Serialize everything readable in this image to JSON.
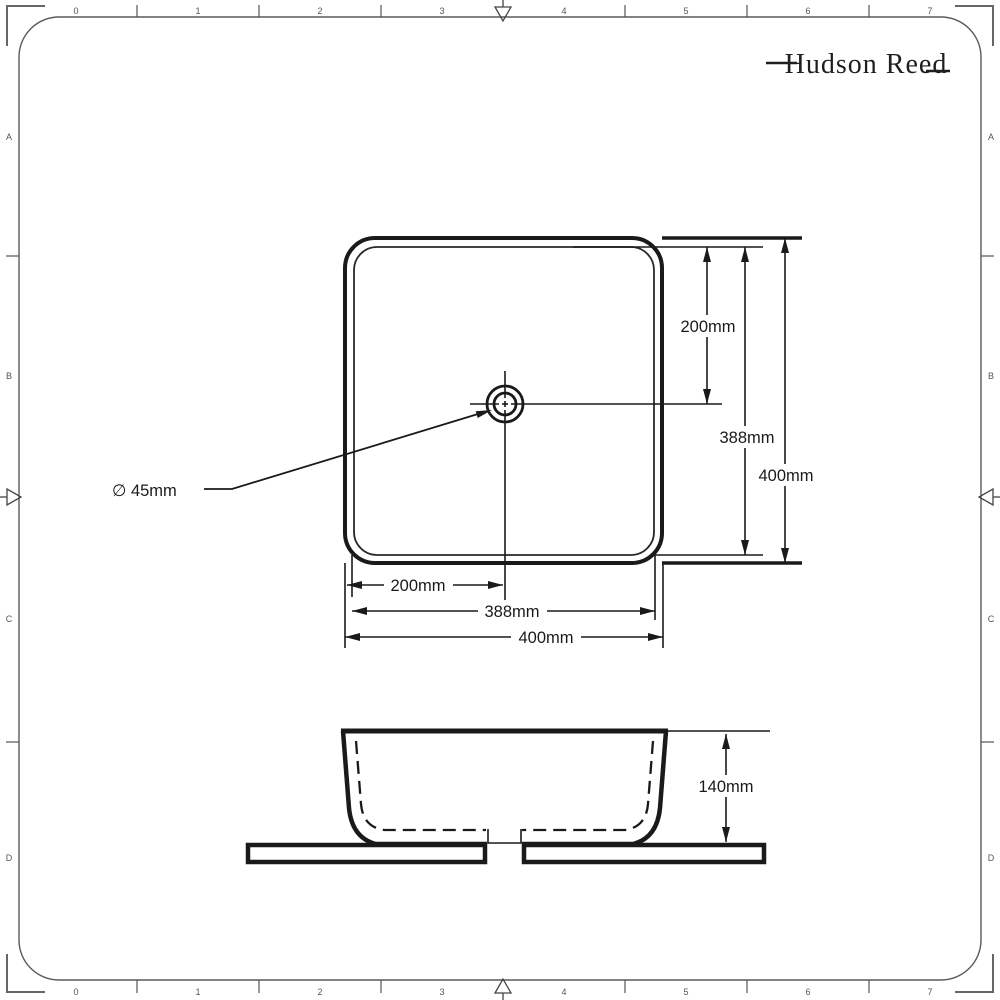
{
  "logo": {
    "text": "Hudson Reed"
  },
  "rulers": {
    "top": [
      "0",
      "1",
      "2",
      "3",
      "4",
      "5",
      "6",
      "7"
    ],
    "bottom": [
      "0",
      "1",
      "2",
      "3",
      "4",
      "5",
      "6",
      "7"
    ],
    "left": [
      "A",
      "B",
      "C",
      "D"
    ],
    "right": [
      "A",
      "B",
      "C",
      "D"
    ]
  },
  "plan_view": {
    "dims_vertical": {
      "center_offset": "200mm",
      "inner": "388mm",
      "outer": "400mm"
    },
    "dims_horizontal": {
      "center_offset": "200mm",
      "inner": "388mm",
      "outer": "400mm"
    },
    "drain_diameter": "∅ 45mm"
  },
  "elevation_view": {
    "height": "140mm"
  },
  "colors": {
    "line": "#1a1a1a",
    "frame": "#5a5a5a",
    "background": "#ffffff"
  }
}
